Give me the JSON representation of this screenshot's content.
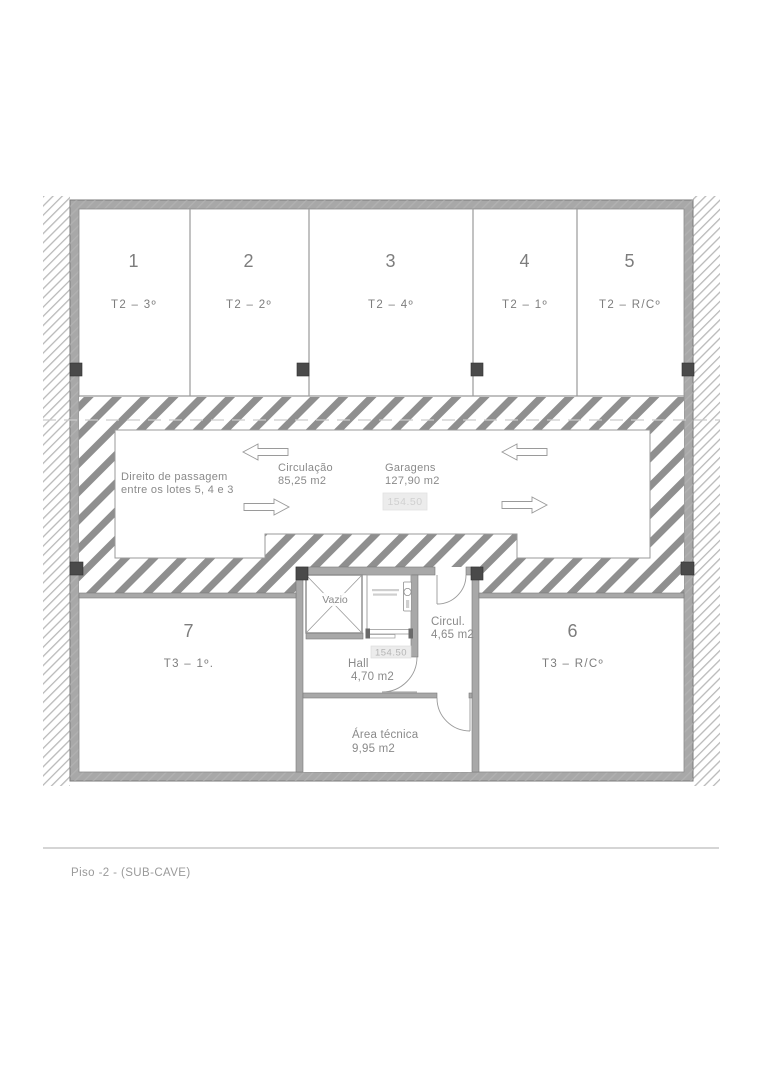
{
  "footer": {
    "label": "Piso -2 - (SUB-CAVE)"
  },
  "garages": {
    "spaces": [
      {
        "number": "1",
        "unit": "T2 – 3º"
      },
      {
        "number": "2",
        "unit": "T2 – 2º"
      },
      {
        "number": "3",
        "unit": "T2 – 4º"
      },
      {
        "number": "4",
        "unit": "T2 – 1º"
      },
      {
        "number": "5",
        "unit": "T2 – R/Cº"
      }
    ]
  },
  "circulation": {
    "easement_line1": "Direito de passagem",
    "easement_line2": "entre os lotes 5, 4 e 3",
    "name": "Circulação",
    "area": "85,25 m2",
    "garages_name": "Garagens",
    "garages_area": "127,90 m2",
    "level": "154.50"
  },
  "core": {
    "void_label": "Vazio",
    "circ_name": "Circul.",
    "circ_area": "4,65 m2",
    "hall_name": "Hall",
    "hall_area": "4,70 m2",
    "hall_level": "154.50",
    "tech_name": "Área técnica",
    "tech_area": "9,95 m2"
  },
  "rooms": [
    {
      "number": "7",
      "unit": "T3 – 1º."
    },
    {
      "number": "6",
      "unit": "T3 – R/Cº"
    }
  ],
  "colors": {
    "wall_fill": "#a8a8a8",
    "wall_edge": "#7a7a7a",
    "hatch_stripe": "#8f8f8f",
    "thin_hatch": "#b9b9b9",
    "column": "#4a4a4a",
    "draw_line": "#9a9a9a",
    "text_gray": "#7d7d7d",
    "level_box_bg": "#ececec"
  }
}
